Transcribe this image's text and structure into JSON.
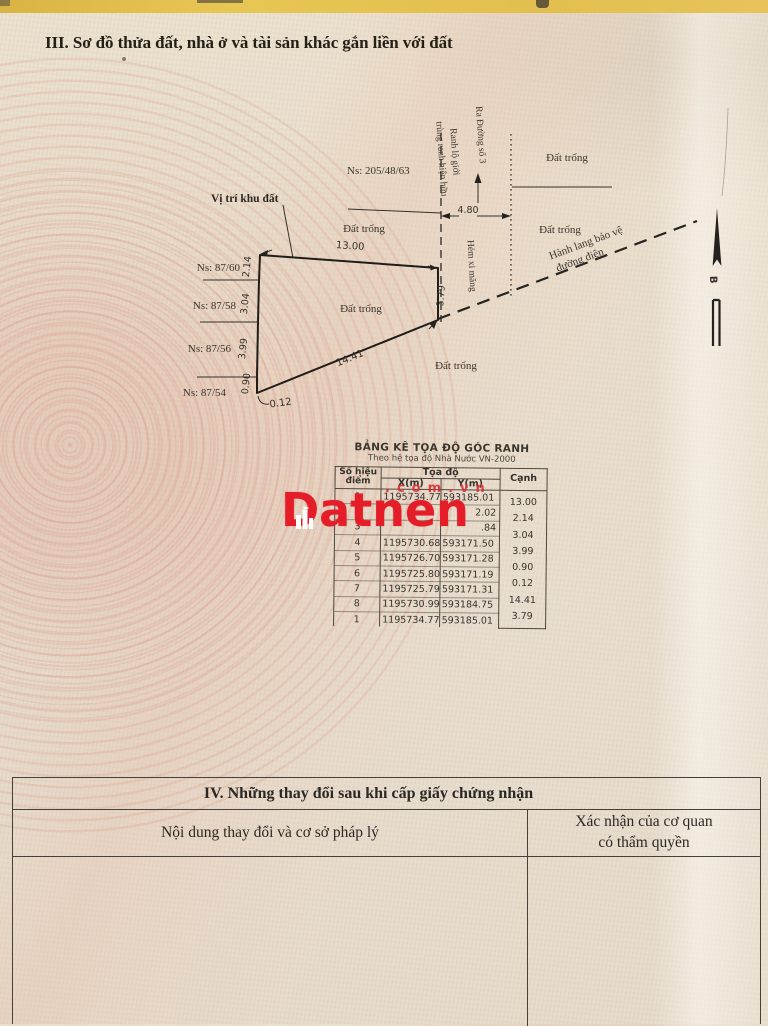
{
  "colors": {
    "watermark_red": "#e41d28",
    "top_strip_yellow": "#e2bf4e"
  },
  "section3": {
    "title": "III. Sơ đồ thửa đất, nhà ở và tài sản khác gắn liền với đất"
  },
  "diagram": {
    "ns_205": "Ns: 205/48/63",
    "vi_tri": "Vị trí khu đất",
    "dat_trong": "Đất trống",
    "ra_duong": "Ra Đường số 3",
    "ranh_1": "Ranh lộ giới",
    "ranh_2": "trùng ranh hiện hữu",
    "hem": "Hẻm xi măng",
    "hanh_lang_1": "Hành lang bảo vệ",
    "hanh_lang_2": "đường điện",
    "ns_8760": "Ns: 87/60",
    "ns_8758": "Ns: 87/58",
    "ns_8756": "Ns: 87/56",
    "ns_8754": "Ns: 87/54",
    "north_letter": "B",
    "dims": {
      "top": "13.00",
      "left1": "2.14",
      "left2": "3.04",
      "left3": "3.99",
      "left4": "0.90",
      "corner": "0.12",
      "diagonal": "14.41",
      "right": "3.79",
      "alley": "4.80"
    }
  },
  "coord_table": {
    "title": "BẢNG KÊ TỌA ĐỘ GÓC RANH",
    "subtitle": "Theo hệ tọa độ Nhà Nước VN-2000",
    "headers": {
      "point_1": "Số hiệu",
      "point_2": "điểm",
      "toado": "Tọa độ",
      "x": "X(m)",
      "y": "Y(m)",
      "canh": "Cạnh"
    },
    "rows": [
      {
        "n": "1",
        "x": "1195734.77",
        "y": "593185.01"
      },
      {
        "n": "2",
        "x": "",
        "y": "2.02"
      },
      {
        "n": "3",
        "x": "",
        "y": ".84"
      },
      {
        "n": "4",
        "x": "1195730.68",
        "y": "593171.50"
      },
      {
        "n": "5",
        "x": "1195726.70",
        "y": "593171.28"
      },
      {
        "n": "6",
        "x": "1195725.80",
        "y": "593171.19"
      },
      {
        "n": "7",
        "x": "1195725.79",
        "y": "593171.31"
      },
      {
        "n": "8",
        "x": "1195730.99",
        "y": "593184.75"
      },
      {
        "n": "1",
        "x": "1195734.77",
        "y": "593185.01"
      }
    ],
    "canh_values": [
      "13.00",
      "2.14",
      "3.04",
      "3.99",
      "0.90",
      "0.12",
      "14.41",
      "3.79"
    ]
  },
  "watermark": {
    "brand": "Datnen",
    "domain": ".com.vn"
  },
  "section4": {
    "title": "IV. Những thay đổi sau khi cấp giấy chứng nhận",
    "col_left": "Nội dung thay đổi và cơ sở pháp lý",
    "col_right_1": "Xác nhận của cơ quan",
    "col_right_2": "có thẩm quyền"
  }
}
